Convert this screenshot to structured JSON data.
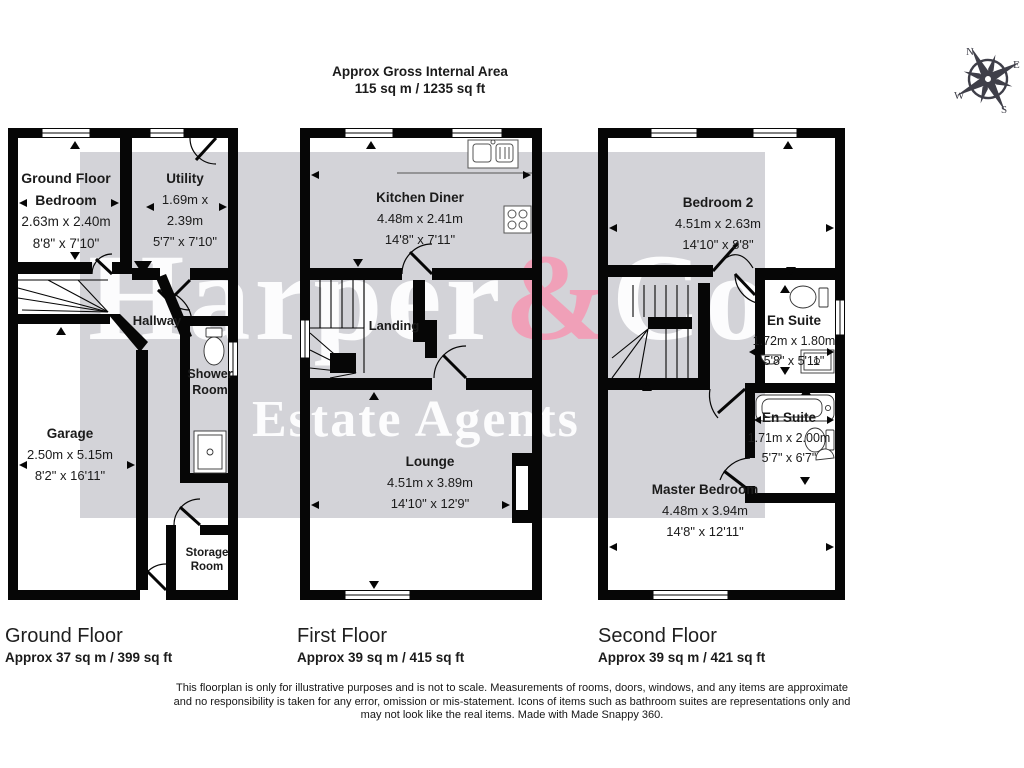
{
  "title": {
    "line1": "Approx Gross Internal Area",
    "line2": "115 sq m / 1235 sq ft"
  },
  "watermark": {
    "name_part1": "Harper",
    "name_amp": "&",
    "name_part2": "Co",
    "line2": "Estate Agents",
    "accent_pink": "#f0a0b8",
    "band_gray": "#d3d3d8"
  },
  "compass": {
    "n": "N",
    "e": "E",
    "s": "S",
    "w": "W"
  },
  "rooms": {
    "bedroom1": {
      "name": "Ground Floor Bedroom",
      "metric": "2.63m x 2.40m",
      "imperial": "8'8\" x 7'10\""
    },
    "utility": {
      "name": "Utility",
      "metric": "1.69m x 2.39m",
      "imperial": "5'7\" x 7'10\""
    },
    "hallway": {
      "name": "Hallway"
    },
    "shower": {
      "name": "Shower Room"
    },
    "garage": {
      "name": "Garage",
      "metric": "2.50m x 5.15m",
      "imperial": "8'2\" x 16'11\""
    },
    "storage": {
      "name": "Storage Room"
    },
    "kitchen": {
      "name": "Kitchen Diner",
      "metric": "4.48m x 2.41m",
      "imperial": "14'8\" x 7'11\""
    },
    "landing": {
      "name": "Landing"
    },
    "lounge": {
      "name": "Lounge",
      "metric": "4.51m x 3.89m",
      "imperial": "14'10\" x 12'9\""
    },
    "bedroom2": {
      "name": "Bedroom 2",
      "metric": "4.51m x 2.63m",
      "imperial": "14'10\" x 8'8\""
    },
    "ensuite1": {
      "name": "En Suite",
      "metric": "1.72m x 1.80m",
      "imperial": "5'8\" x 5'11\""
    },
    "ensuite2": {
      "name": "En Suite",
      "metric": "1.71m x 2.00m",
      "imperial": "5'7\" x 6'7\""
    },
    "master": {
      "name": "Master Bedroom",
      "metric": "4.48m x 3.94m",
      "imperial": "14'8\" x 12'11\""
    }
  },
  "floors": [
    {
      "label": "Ground Floor",
      "area": "Approx 37 sq m / 399 sq ft"
    },
    {
      "label": "First Floor",
      "area": "Approx 39 sq m / 415 sq ft"
    },
    {
      "label": "Second Floor",
      "area": "Approx 39 sq m / 421 sq ft"
    }
  ],
  "disclaimer": {
    "line1": "This floorplan is only for illustrative purposes and is not to scale. Measurements of rooms, doors, windows, and any items are approximate",
    "line2": "and no responsibility is taken for any error, omission or mis-statement. Icons of items such as bathroom suites are representations only and",
    "line3": "may not look like the real items. Made with Made Snappy 360."
  }
}
